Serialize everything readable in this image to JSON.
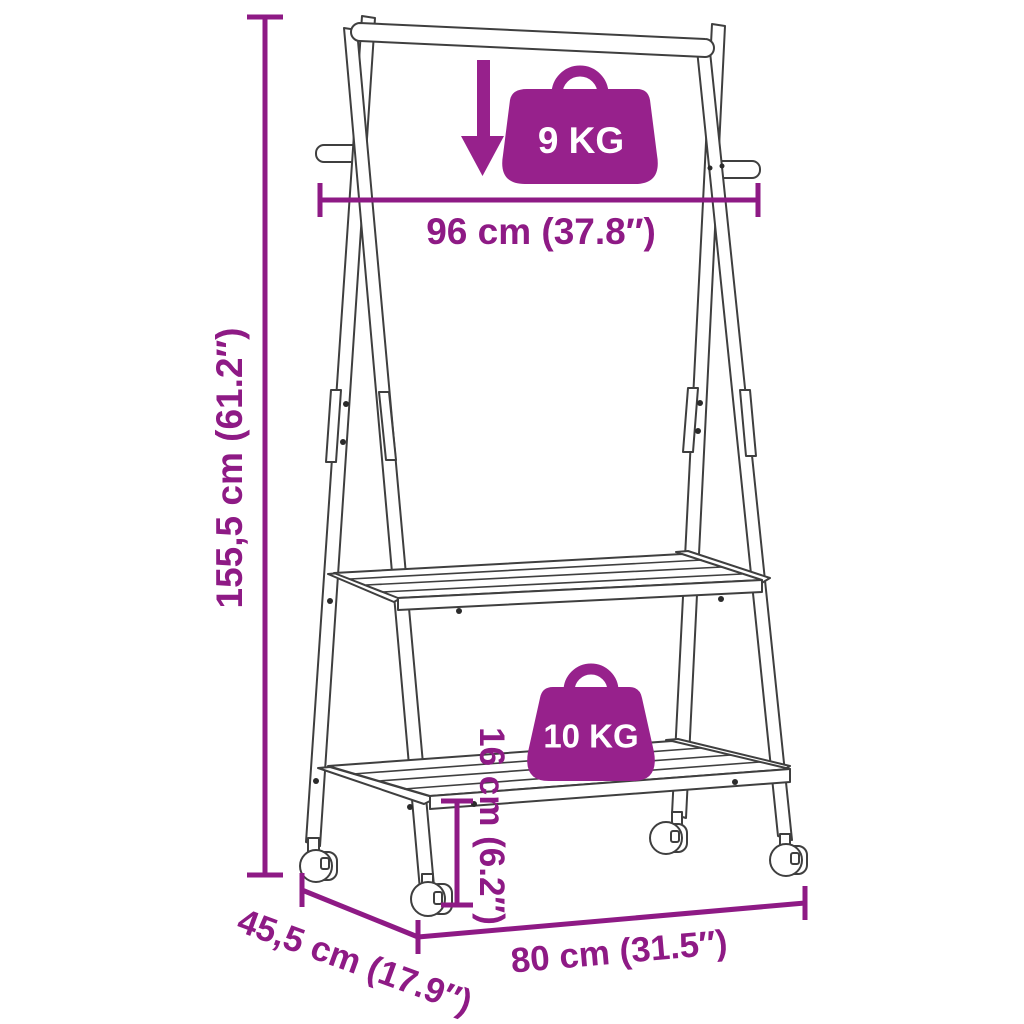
{
  "diagram": {
    "title": "Clothes rack with wheels - dimension diagram",
    "background": "#ffffff",
    "colors": {
      "dimension_lines": "#8e1a85",
      "capacity_badges": "#97218c",
      "product_outline": "#3f3f3f",
      "badge_text": "#ffffff"
    },
    "icons": [
      "down-arrow-icon",
      "weight-bag-icon"
    ],
    "labels": {
      "height": "155,5 cm (61.2″)",
      "hanging_bar_width": "96 cm (37.8″)",
      "base_width": "80 cm (31.5″)",
      "depth": "45,5 cm (17.9″)",
      "bottom_shelf_height": "16 cm (6.2″)",
      "rail_capacity": "9 KG",
      "shelf_capacity": "10 KG"
    }
  }
}
